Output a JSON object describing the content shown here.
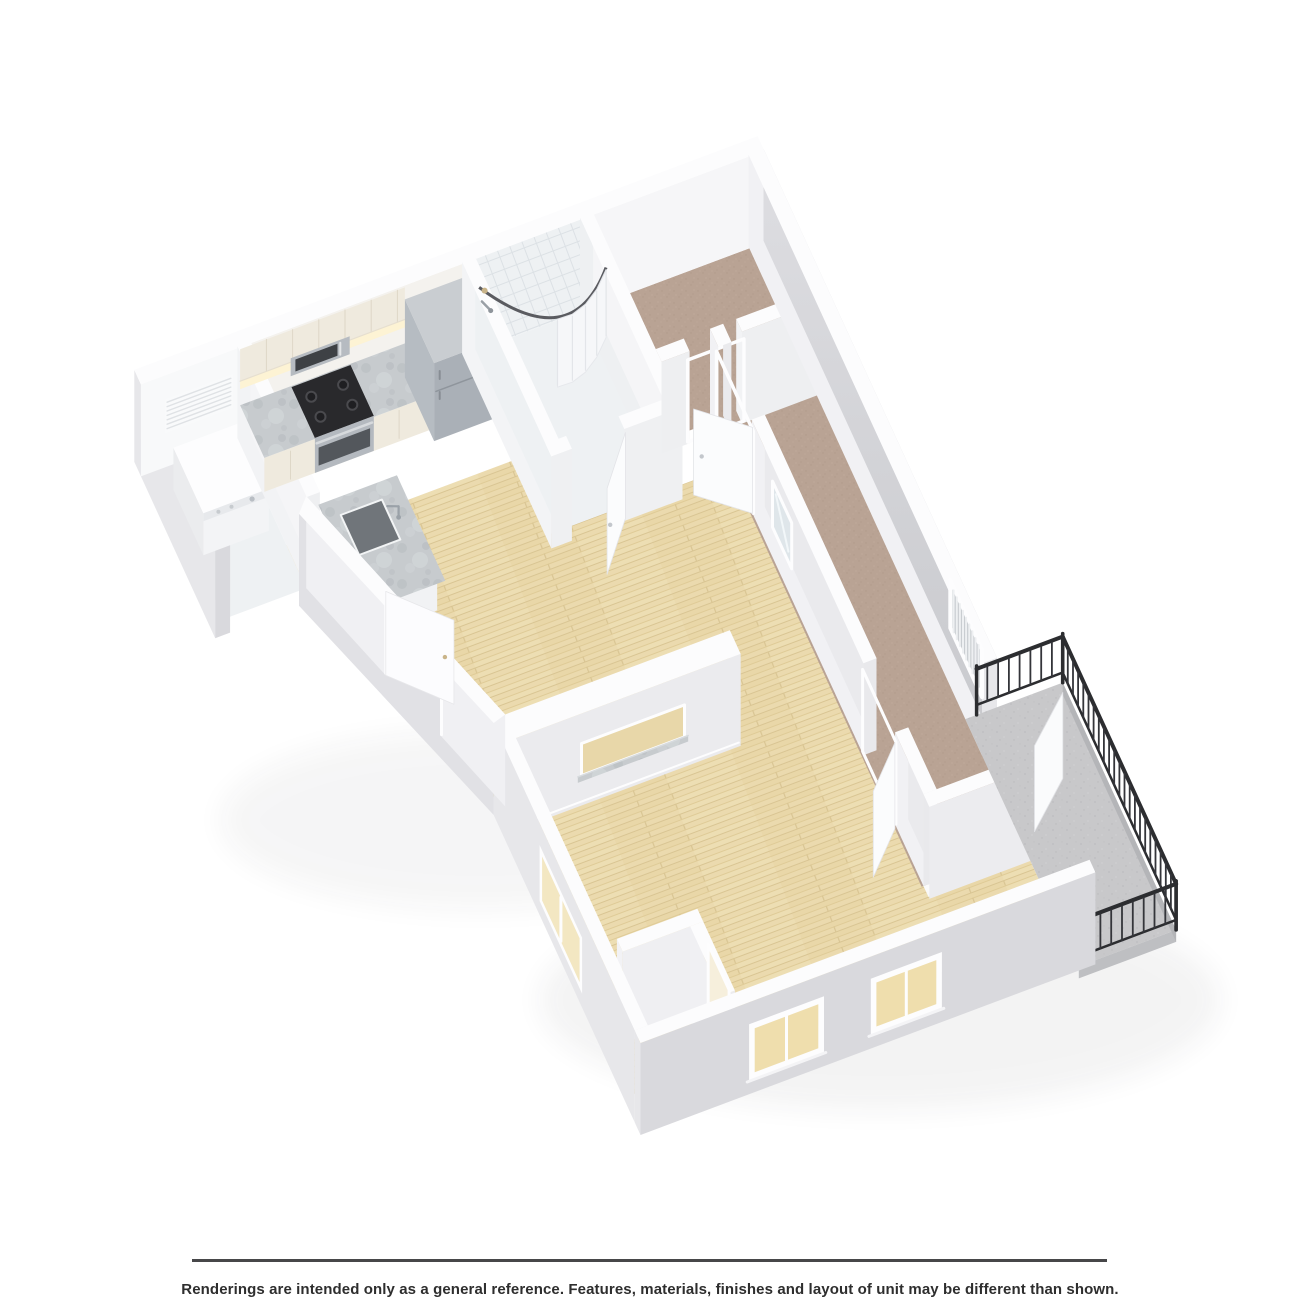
{
  "disclaimer": "Renderings are intended only as a general reference. Features, materials, finishes and layout of unit may be different than shown.",
  "image": {
    "type": "3d-isometric-floor-plan-rendering",
    "rooms": [
      "laundry-closet",
      "kitchen",
      "entry-hall",
      "bathroom",
      "walk-in-closet",
      "bedroom",
      "living-room",
      "balcony"
    ],
    "features": [
      "washer",
      "louver-vent",
      "upper-cabinets",
      "base-cabinets",
      "microwave",
      "stove",
      "refrigerator",
      "peninsula-sink",
      "shower-with-curved-rod",
      "shower-curtain",
      "pass-through-with-granite-sill",
      "open-doors",
      "windows",
      "black-metal-balcony-railing"
    ]
  },
  "colors": {
    "background": "#ffffff",
    "wallTop": "#fcfcfd",
    "intS": "#f0f0f3",
    "intW": "#f5f5f7",
    "intE": "#eaeaed",
    "extS": "#d9d9dd",
    "extW": "#e7e7ea",
    "extDiag": "#e1e1e5",
    "woodBase": "#ebdaae",
    "woodLine": "#d9c593",
    "carpet": "#b9a394",
    "tile": "#eef1f3",
    "tileLine": "#dce1e5",
    "granite": "#c7cbce",
    "concrete": "#c8c8ca",
    "cabinet": "#efeade",
    "cabinetLine": "#ded7c7",
    "stainless": "#aab0b7",
    "stainlessLight": "#b6bcc2",
    "stainlessDark": "#989ea5",
    "stainlessTop": "#c9cdd1",
    "cooktop": "#29292c",
    "glow": "#fdf2d2",
    "curtain": "#f7f8fa",
    "railing": "#2c2d30",
    "railingBar": "#34353a",
    "mirror": "#dfe6ea",
    "brass": "#c9b489",
    "rule": "#474749",
    "text": "#2e2e2e"
  }
}
